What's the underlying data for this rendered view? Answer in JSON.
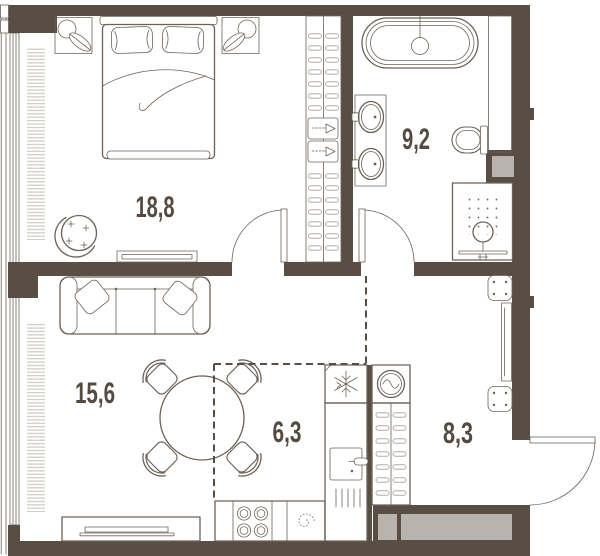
{
  "floor_plan": {
    "rooms": [
      {
        "name": "bedroom",
        "area_label": "18,8"
      },
      {
        "name": "bathroom",
        "area_label": "9,2"
      },
      {
        "name": "living-room",
        "area_label": "15,6"
      },
      {
        "name": "kitchen",
        "area_label": "6,3"
      },
      {
        "name": "hallway",
        "area_label": "8,3"
      }
    ],
    "colors": {
      "wall": "#584e43",
      "line": "#6d6156",
      "light_line": "#ccc7c0",
      "panel": "#b8b3ac",
      "label": "#544a40",
      "bg": "#ffffff"
    },
    "furniture_icons": [
      "double-bed-icon",
      "pillow-icon",
      "nightstand-lamp-icon",
      "armchair-icon",
      "dresser-icon",
      "wardrobe-hanger-icon",
      "storage-box-icon",
      "sofa-icon",
      "dining-table-icon",
      "chair-icon",
      "tv-stand-icon",
      "radiator-icon",
      "window-icon",
      "bathtub-icon",
      "faucet-icon",
      "sink-icon",
      "toilet-icon",
      "shower-icon",
      "duct-shaft-icon",
      "washing-machine-icon",
      "snowflake-fridge-icon",
      "oven-icon",
      "vent-icon",
      "stove-burner-icon",
      "kitchen-sink-spiral-icon",
      "stool-icon",
      "console-icon",
      "door-swing-icon"
    ]
  }
}
